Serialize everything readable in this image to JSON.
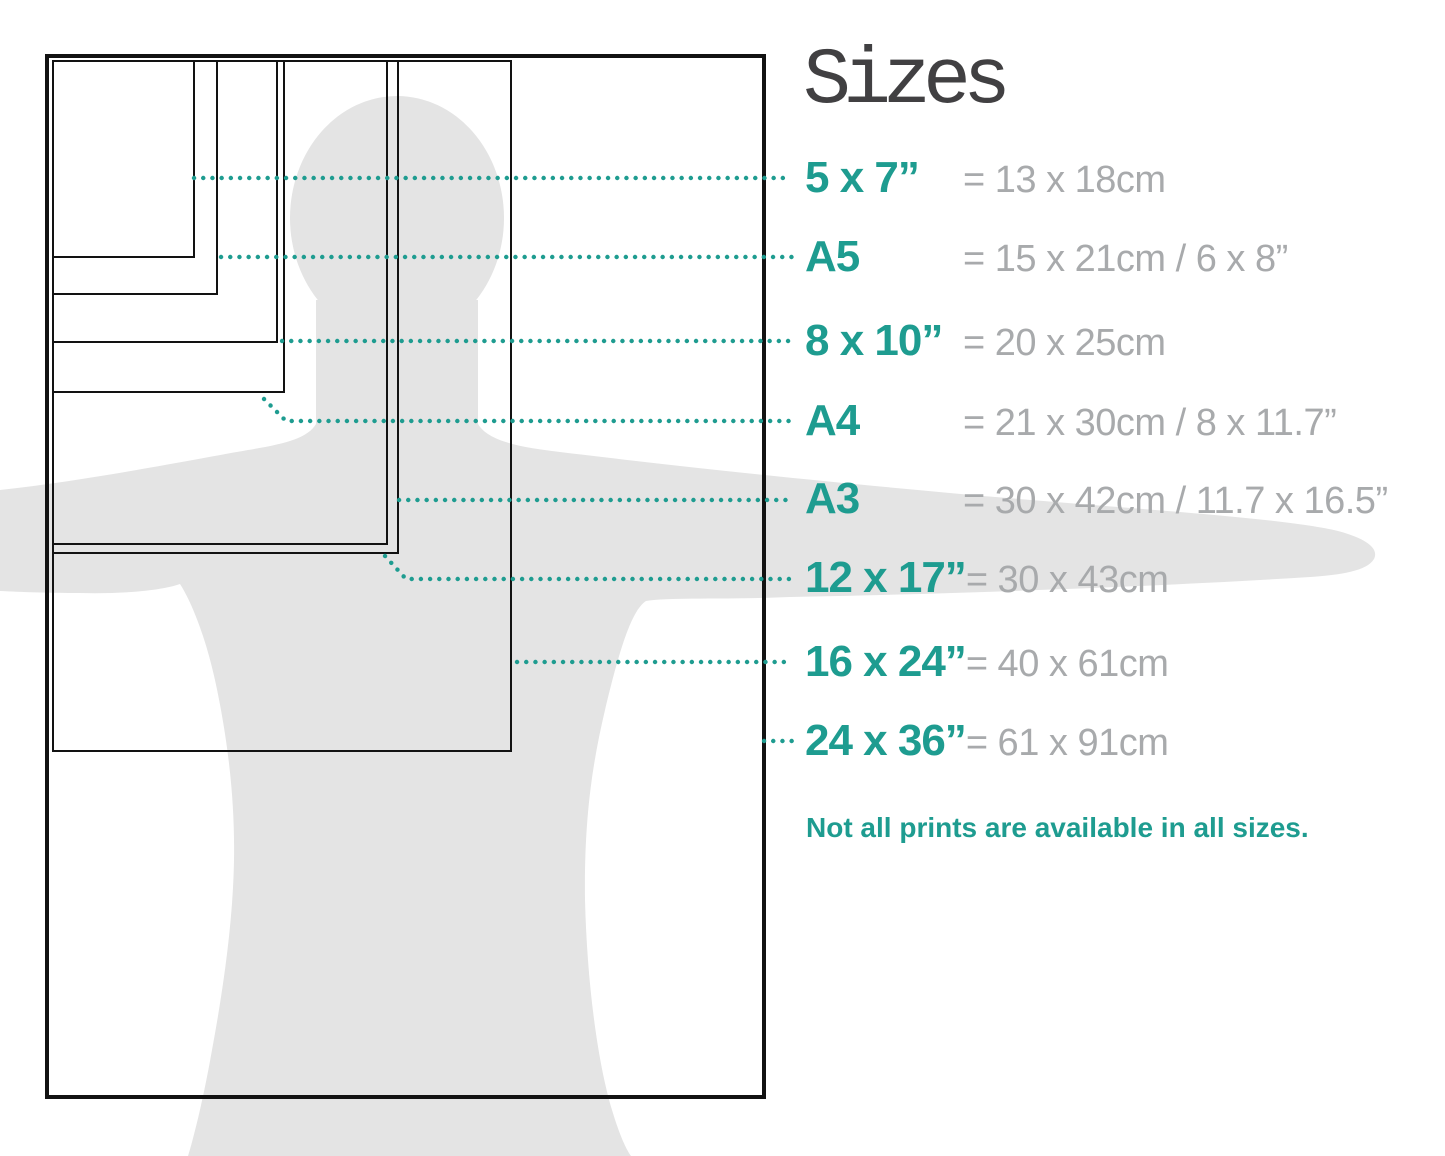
{
  "title": "Sizes",
  "note": "Not all prints are available in all sizes.",
  "colors": {
    "accent": "#1E9C90",
    "muted_text": "#A8AAAC",
    "title_text": "#414042",
    "silhouette": "#E4E4E4",
    "outline": "#121212"
  },
  "sizes": [
    {
      "id": "5x7",
      "label": "5 x 7”",
      "metric": "= 13 x 18cm"
    },
    {
      "id": "a5",
      "label": "A5",
      "metric": "= 15 x 21cm / 6 x 8”"
    },
    {
      "id": "8x10",
      "label": "8 x 10”",
      "metric": "= 20 x 25cm"
    },
    {
      "id": "a4",
      "label": "A4",
      "metric": "= 21 x 30cm / 8 x 11.7”"
    },
    {
      "id": "a3",
      "label": "A3",
      "metric": "= 30 x 42cm / 11.7 x 16.5”"
    },
    {
      "id": "12x17",
      "label": "12 x 17”",
      "metric": "= 30 x 43cm"
    },
    {
      "id": "16x24",
      "label": "16 x 24”",
      "metric": "= 40 x 61cm"
    },
    {
      "id": "24x36",
      "label": "24 x 36”",
      "metric": "= 61 x 91cm"
    }
  ]
}
